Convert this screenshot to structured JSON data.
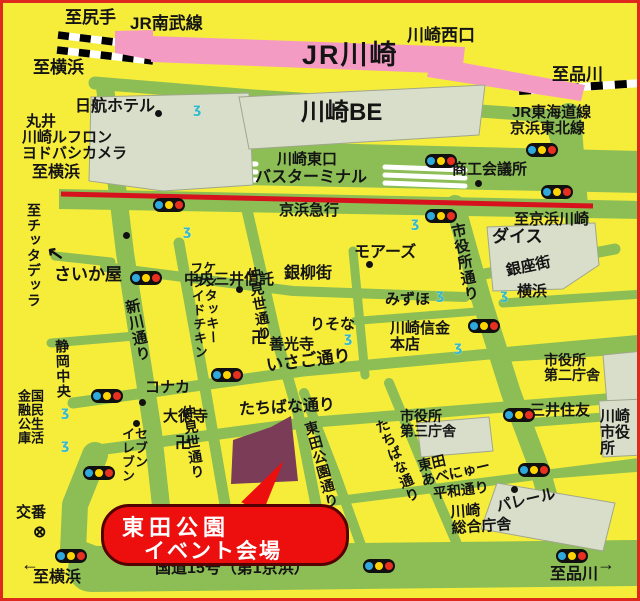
{
  "bubble": {
    "line1": "東田公園",
    "line2": "イベント会場"
  },
  "labels": {
    "to_shitte": "至尻手",
    "jr_nambu_line": "JR南武線",
    "to_yokohama_top": "至横浜",
    "kawasaki_west_exit": "川崎西口",
    "jr_kawasaki": "JR川崎",
    "to_shinagawa_top": "至品川",
    "jr_tokaido_line": "JR東海道線",
    "keihin_tohoku_line": "京浜東北線",
    "nikko_hotel": "日航ホテル",
    "marui": "丸井",
    "kawasaki_le_front": "川崎ルフロン",
    "yodobashi_camera": "ヨドバシカメラ",
    "to_yokohama_left": "至横浜",
    "kawasaki_be": "川崎BE",
    "kawasaki_east_exit": "川崎東口",
    "bus_terminal": "バスターミナル",
    "keihin_kyuko": "京浜急行",
    "shoko_kaigisho": "商工会議所",
    "to_keihin_kawasaki": "至京浜川崎",
    "saikaya": "さいか屋",
    "chuo_mitsui_trust": "中央三井信託",
    "ginryu_gai": "銀柳街",
    "moars": "モアーズ",
    "dice": "ダイス",
    "ginza_gai": "銀座街",
    "yokohama_bank": "横浜",
    "mizuho": "みずほ",
    "risona": "りそな",
    "zenkoji": "善光寺",
    "isago_dori": "いさご通り",
    "kawasaki_shinkin": "川崎信金\n本店",
    "mitsui_sumitomo": "三井住友",
    "shiyakusho_dai2": "市役所\n第二庁舎",
    "shiyakusho_dai3": "市役所\n第三庁舎",
    "kawasaki_city_hall": "川崎\n市役所",
    "tachibana_dori_h": "たちばな通り",
    "konaka": "コナカ",
    "daitokuji": "大徳寺",
    "heiwa_dori": "平和通り",
    "higashida_avenue": "東田\nあべにゅー",
    "palare": "パレール",
    "kawasaki_sogo": "川崎\n総合庁舎",
    "koban": "交番",
    "route15": "国道15号（第1京浜）",
    "to_yokohama_bottom": "至横浜",
    "to_shinagawa_bottom": "至品川",
    "to_cittadella": "至チッタデッラ",
    "shinkawa_dori": "新川通り",
    "shizuoka_chuo": "静岡中央",
    "kokumin_seikatsu": "国民生活\n金融公庫",
    "nakamise_upper": "仲見世通り",
    "nakamise_lower": "仲見世通り",
    "kfc": "ケンタッキー\nフライドチキン",
    "seven_eleven": "セブン\nイレブン",
    "shiyakusho_dori": "市役所通り",
    "higashida_koen_dori": "東田公園通り",
    "tachibana_dori_diag": "たちばな通り"
  },
  "icons": {
    "manji": "卍",
    "koban_mark": "⊗",
    "arrow_left": "←",
    "arrow_right": "→",
    "arrow_upleft": "↖",
    "pedestrian": "ʒ"
  },
  "colors": {
    "background": "#F6ED3B",
    "road_green": "#8CBE55",
    "station_pink": "#F49BC4",
    "building_gray": "#D9DECA",
    "keihin_rail_red": "#D6131D",
    "park_purple": "#7B3C57",
    "bubble_red": "#ED0E0E",
    "signal_blue": "#2FA8DC",
    "signal_yellow": "#FFD400",
    "signal_red": "#E83020"
  }
}
